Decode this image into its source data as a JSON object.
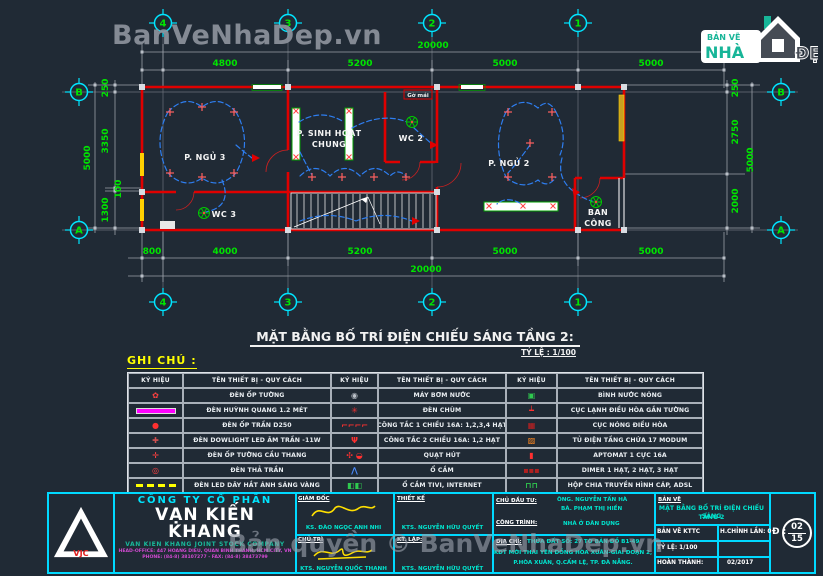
{
  "watermark_top": "BanVeNhaDep.vn",
  "watermark_bottom": "Bản quyền © BanVeNhaDep.vn",
  "logo": {
    "line1": "BẢN VẼ",
    "line2": "NHÀ",
    "line3": "ĐẸP"
  },
  "plan": {
    "grid_cols": [
      "4",
      "3",
      "2",
      "1"
    ],
    "grid_rows": [
      "B",
      "A"
    ],
    "dims_top": [
      "4800",
      "5200",
      "5000",
      "5000"
    ],
    "dim_top_total": "20000",
    "dims_bottom": [
      "800",
      "4000",
      "5200",
      "5000",
      "5000"
    ],
    "dim_bottom_total": "20000",
    "dims_left": [
      "250",
      "3350",
      "100",
      "1300"
    ],
    "dim_left_total": "5000",
    "dims_right": [
      "250",
      "2750",
      "2000"
    ],
    "dim_right_total": "5000",
    "rooms": [
      "P. NGỦ 3",
      "P. SINH HOẠT",
      "CHUNG",
      "WC 2",
      "P. NGỦ 2",
      "WC 3",
      "BAN",
      "CÔNG"
    ],
    "tag": "Gờ mái"
  },
  "drawing_title": {
    "text": "MẶT BẰNG BỐ TRÍ ĐIỆN CHIẾU SÁNG TẦNG 2:",
    "scale": "TỶ LỆ : 1/100"
  },
  "legend": {
    "heading": "GHI CHÚ :",
    "header_symbol": "KÝ HIỆU",
    "header_name": "TÊN THIẾT BỊ - QUY CÁCH",
    "columns": [
      {
        "rows": [
          {
            "icon": "den-op-tuong-icon",
            "label": "ĐÈN ỐP TƯỜNG"
          },
          {
            "icon": "den-huynh-quang-icon",
            "label": "ĐÈN HUỲNH QUANG 1.2 MÉT"
          },
          {
            "icon": "den-op-tran-icon",
            "label": "ĐÈN ỐP TRẦN D250"
          },
          {
            "icon": "den-downlight-icon",
            "label": "ĐÈN DOWLIGHT LED ÂM TRẦN -11W"
          },
          {
            "icon": "den-op-tuong-cau-thang-icon",
            "label": "ĐÈN ỐP TƯỜNG CẦU THANG"
          },
          {
            "icon": "den-tha-tran-icon",
            "label": "ĐÈN THẢ TRẦN"
          },
          {
            "icon": "den-led-day-icon",
            "label": "ĐÈN LED DÂY HẮT ÁNH SÁNG VÀNG"
          }
        ]
      },
      {
        "rows": [
          {
            "icon": "may-bom-nuoc-icon",
            "label": "MÁY BƠM NƯỚC"
          },
          {
            "icon": "den-chum-icon",
            "label": "ĐÈN CHÙM"
          },
          {
            "icon": "cong-tac-1-chieu-icon",
            "label": "CÔNG TẮC 1 CHIỀU 16A: 1,2,3,4 HẠT"
          },
          {
            "icon": "cong-tac-2-chieu-icon",
            "label": "CÔNG TẮC 2 CHIỀU 16A: 1,2 HẠT"
          },
          {
            "icon": "quat-hut-icon",
            "label": "QUẠT HÚT"
          },
          {
            "icon": "o-cam-icon",
            "label": "Ổ CẮM"
          },
          {
            "icon": "o-cam-tivi-icon",
            "label": "Ổ CẮM TIVI, INTERNET"
          }
        ]
      },
      {
        "rows": [
          {
            "icon": "binh-nuoc-nong-icon",
            "label": "BÌNH NƯỚC NÓNG"
          },
          {
            "icon": "cuc-lanh-icon",
            "label": "CỤC LẠNH ĐIỀU HÒA GẮN TƯỜNG"
          },
          {
            "icon": "cuc-nong-icon",
            "label": "CỤC NÓNG ĐIỀU HÒA"
          },
          {
            "icon": "tu-dien-icon",
            "label": "TỦ ĐIỆN TẦNG CHỨA 17 MODUM"
          },
          {
            "icon": "aptomat-icon",
            "label": "APTOMAT 1 CỰC 16A"
          },
          {
            "icon": "dimer-icon",
            "label": "DIMER 1 HẠT, 2 HẠT, 3 HẠT"
          },
          {
            "icon": "hop-chia-icon",
            "label": "HỘP CHIA TRUYỀN HÌNH CÁP, ADSL"
          }
        ]
      }
    ]
  },
  "title_block": {
    "company": {
      "type": "CÔNG TY CỔ PHẦN",
      "name": "VẠN KIẾN KHANG",
      "name_en": "VAN KIEN KHANG JOINT STOCK COMPANY",
      "address": "HEAD-OFFICE: 447 HOANG DIEU, QUAN BINH THANH, HCM CITY, VN",
      "phone": "PHONE: (84-8) 38107277  -  FAX: (84-8) 38473799",
      "logo_text": "VJC"
    },
    "sigs": [
      {
        "role": "GIÁM ĐỐC",
        "name": "KS. ĐÀO NGỌC ANH NHI"
      },
      {
        "role": "THIẾT KẾ",
        "name": "KTS. NGUYỄN HỮU QUYẾT"
      },
      {
        "role": "CHỦ TRÌ",
        "name": "KTS. NGUYỄN QUỐC THANH"
      },
      {
        "role": "KT. LẬP:",
        "name": "KTS. NGUYỄN HỮU QUYẾT"
      }
    ],
    "project": {
      "client_label": "CHỦ ĐẦU TƯ:",
      "client1": "ÔNG. NGUYỄN TẤN HÀ",
      "client2": "BÀ. PHẠM THỊ HIỀN",
      "work_label": "CÔNG TRÌNH:",
      "work": "NHÀ Ở DÂN DỤNG",
      "addr_label": "ĐỊA CHỈ:",
      "addr1": "THỬA ĐẤT SỐ: 27 TỜ BẢN ĐỒ B1-49",
      "addr2": "KĐT MỚI THÁI YÊN ĐỒNG HÒA XUÂN-GIAI ĐOẠN 2,",
      "addr3": "P.HÒA XUÂN, Q.CẨM LỆ, TP. ĐÀ NẴNG."
    },
    "drawing": {
      "label": "BẢN VẼ",
      "title1": "MẶT BẰNG BỐ TRÍ ĐIỆN CHIẾU SÁNG",
      "title2": "TẦNG 2",
      "row1_left": "BẢN VẼ KTTC",
      "row1_right": "H.CHỈNH LẦN: 0",
      "row2_left": "TỶ LỆ: 1/100",
      "row2_right": "",
      "row3_left": "HOÀN THÀNH:",
      "row3_right": "02/2017"
    },
    "sheet": {
      "label": "Đ :",
      "num": "02",
      "total": "15"
    }
  }
}
